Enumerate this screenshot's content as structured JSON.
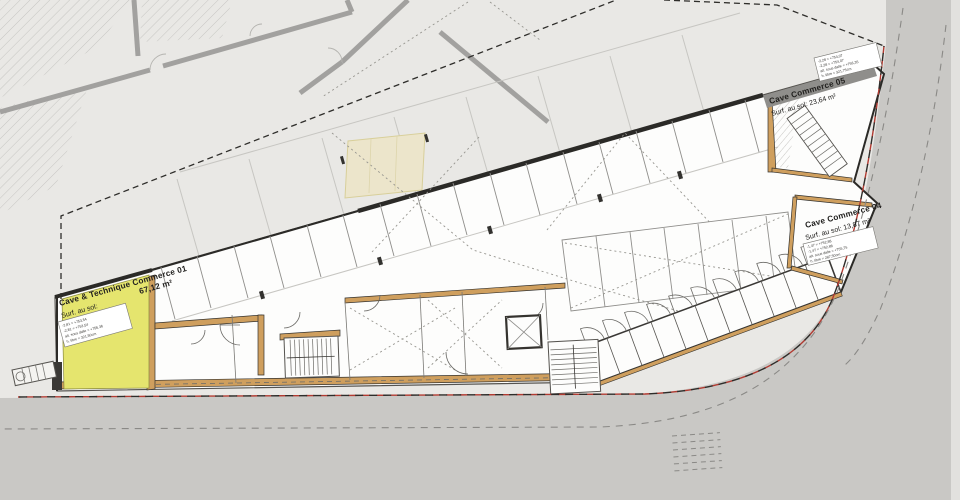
{
  "labels": {
    "room01": {
      "name": "Cave & Technique Commerce 01",
      "area": "67,12 m²",
      "surface": "Surf. au sol:"
    },
    "room05": {
      "name": "Cave Commerce 05",
      "surface": "Surf. au sol: 23,64 m²"
    },
    "room04": {
      "name": "Cave Commerce 04",
      "surface": "Surf. au sol: 13,87 m²"
    }
  },
  "notes": {
    "room01": [
      "-2,81 = +753,54",
      "-2,81 = +753,54",
      "alt. sous dalle = +756,36",
      "h. libre = 321,50cm"
    ],
    "room05": [
      "-2,28 = +754,07",
      "-2,28 = +754,07",
      "alt. sous dalle = +756,35",
      "h. libre = 321,75cm"
    ],
    "room04": [
      "-1,47 = +752,88",
      "-1,47 = +752,88",
      "alt. sous dalle = +755,75",
      "h. libre = 287,50cm"
    ]
  },
  "colors": {
    "highlight_room": "#e5e56e",
    "ramp_zone": "#ece5cb",
    "wall_masonry": "#cf9f5e",
    "boundary_red": "#b23b32",
    "street_gray": "#c9c8c5",
    "plan_bg": "#e9e8e5"
  }
}
